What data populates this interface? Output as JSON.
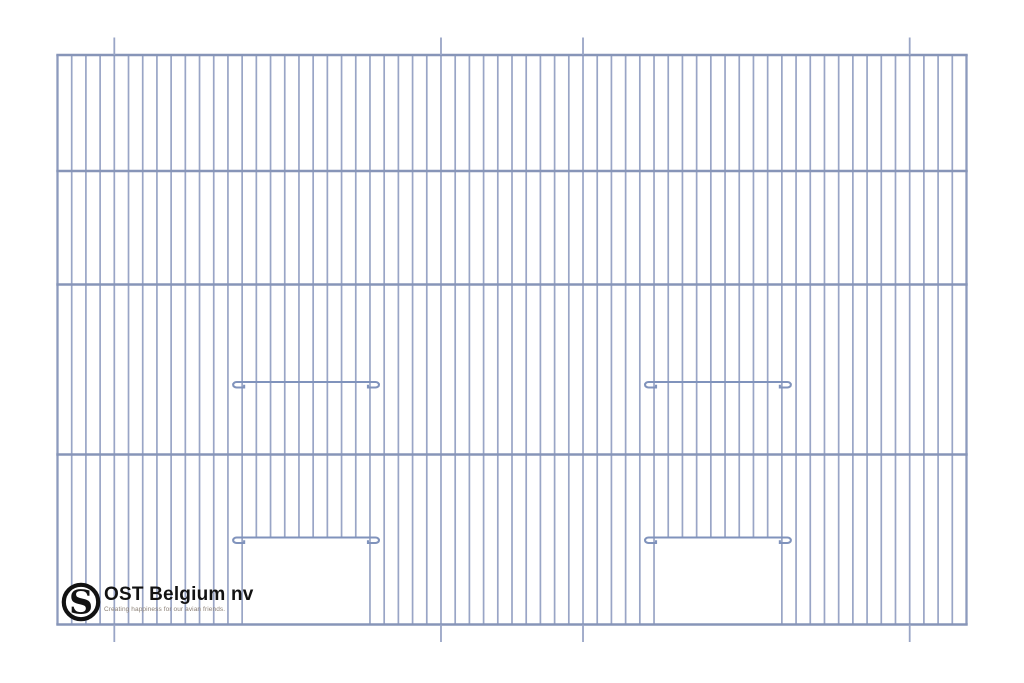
{
  "page": {
    "background_color": "#ffffff",
    "description": "Technical line drawing of a wire cage front panel with two sliding-door openings"
  },
  "drawing": {
    "type": "cage-front-panel",
    "wire_color": "#99a5c6",
    "edge_wire_color": "#8d9abd",
    "rail_color": "#8795b8",
    "hook_wire_color": "#8093bc",
    "wire_width": 1.7,
    "edge_wire_width": 2.3,
    "rail_width": 2.6,
    "hook_wire_width": 2.1,
    "panel": {
      "left": 57.5,
      "top": 55,
      "right": 966.5,
      "bottom": 624.5
    },
    "num_vertical_wires": 65,
    "horizontal_rails_y": [
      55,
      171,
      284.5,
      454.5,
      624.5
    ],
    "tick_wire_indices": [
      4,
      27,
      37,
      60
    ],
    "tick_length": 17.5,
    "door_hook_rows_y": [
      382,
      537.5
    ],
    "hook_overhang": 9,
    "hook_drop": 5.5,
    "door_openings": [
      {
        "left_wire_index": 13,
        "right_wire_index": 22,
        "top_y": 537.5
      },
      {
        "left_wire_index": 42,
        "right_wire_index": 51,
        "top_y": 537.5
      }
    ]
  },
  "logo": {
    "name": "OST Belgium nv",
    "tagline": "Creating happiness for our avian friends.",
    "monogram_letter": "S",
    "mark_color": "#121212",
    "text_color": "#121212",
    "tagline_color": "#8c8177"
  }
}
